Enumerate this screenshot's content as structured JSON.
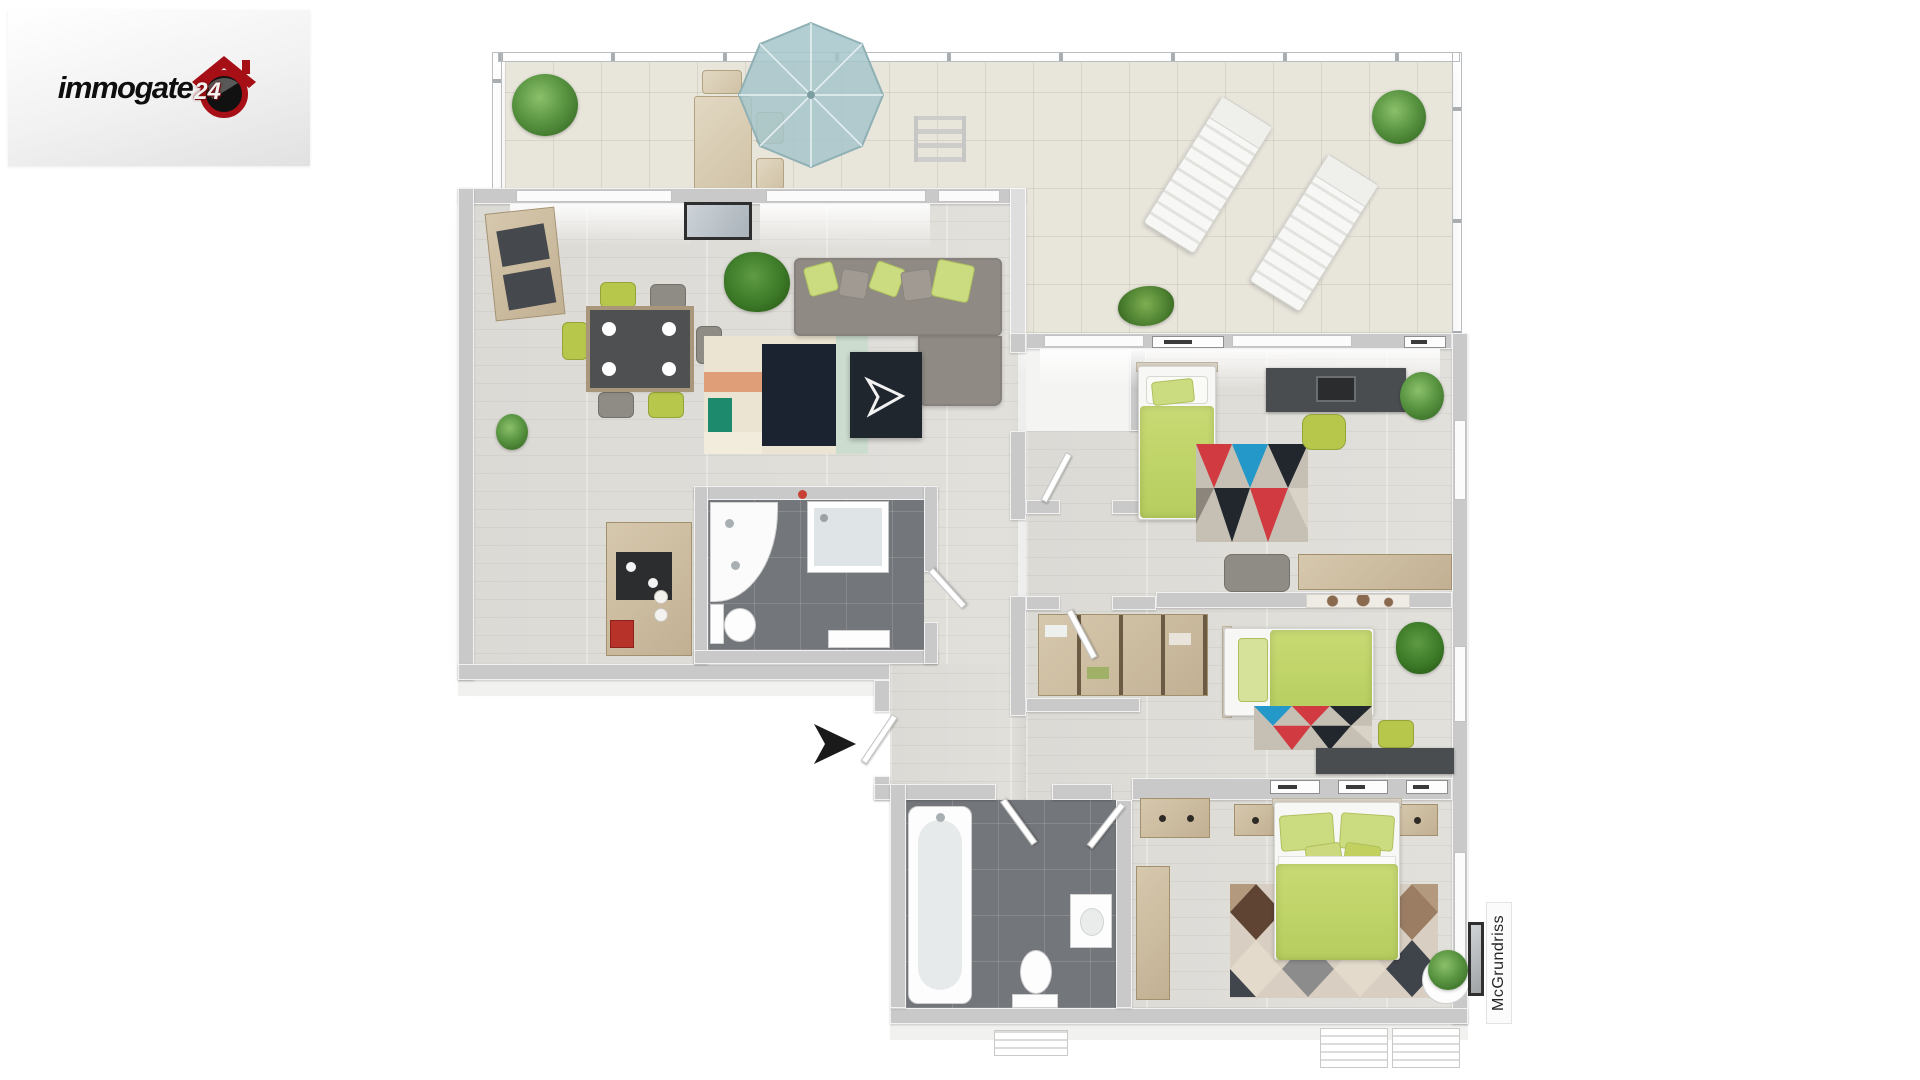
{
  "branding": {
    "logo_text": "immogate",
    "logo_number": "24"
  },
  "watermark": {
    "text": "McGrundriss"
  },
  "palette": {
    "accent_lime": "#bcd266",
    "duvet_lime": "#c0d468",
    "parasol_teal": "#a6c6ca",
    "wall_gray": "#c9c9c9",
    "wood_floor": "#dedcd7",
    "terrace_tile": "#e8e5db",
    "bath_tile": "#73767a",
    "sofa_gray": "#8f8a84",
    "logo_red": "#a50f15",
    "rug_navy": "#1b2330",
    "rug_salmon": "#df9d78",
    "rug_teal": "#1d8a6e",
    "rug_red": "#d23a42",
    "rug_blue": "#2398c9"
  },
  "rooms": [
    {
      "id": "terrace",
      "furniture": [
        "potted-plant",
        "outdoor-dining-table",
        "outdoor-chairs",
        "parasol",
        "deck-ladder",
        "grass-plant",
        "bush",
        "sun-lounger-1",
        "sun-lounger-2"
      ]
    },
    {
      "id": "living-dining",
      "furniture": [
        "corner-cabinet",
        "dining-table",
        "dining-chairs",
        "corner-sofa",
        "coffee-table",
        "area-rug",
        "palm-plant",
        "wall-picture",
        "kitchenette"
      ]
    },
    {
      "id": "bathroom-top",
      "furniture": [
        "corner-washbasin",
        "shower-cabin",
        "toilet",
        "cabinet"
      ]
    },
    {
      "id": "hallway",
      "furniture": [
        "entrance-door",
        "entrance-arrow"
      ]
    },
    {
      "id": "bedroom-1",
      "furniture": [
        "single-bed",
        "desk",
        "desk-chair",
        "laptop",
        "area-rug",
        "plant",
        "sideboard",
        "armchair"
      ]
    },
    {
      "id": "bedroom-2",
      "furniture": [
        "single-bed",
        "wardrobe-shelves",
        "desk",
        "desk-chair",
        "area-rug",
        "plant",
        "wall-map"
      ]
    },
    {
      "id": "bedroom-master",
      "furniture": [
        "double-bed",
        "nightstand-left",
        "nightstand-right",
        "wardrobe",
        "dresser",
        "diamond-rug",
        "plant"
      ]
    },
    {
      "id": "bathroom-bottom",
      "furniture": [
        "bathtub",
        "toilet",
        "washbasin",
        "door"
      ]
    }
  ]
}
